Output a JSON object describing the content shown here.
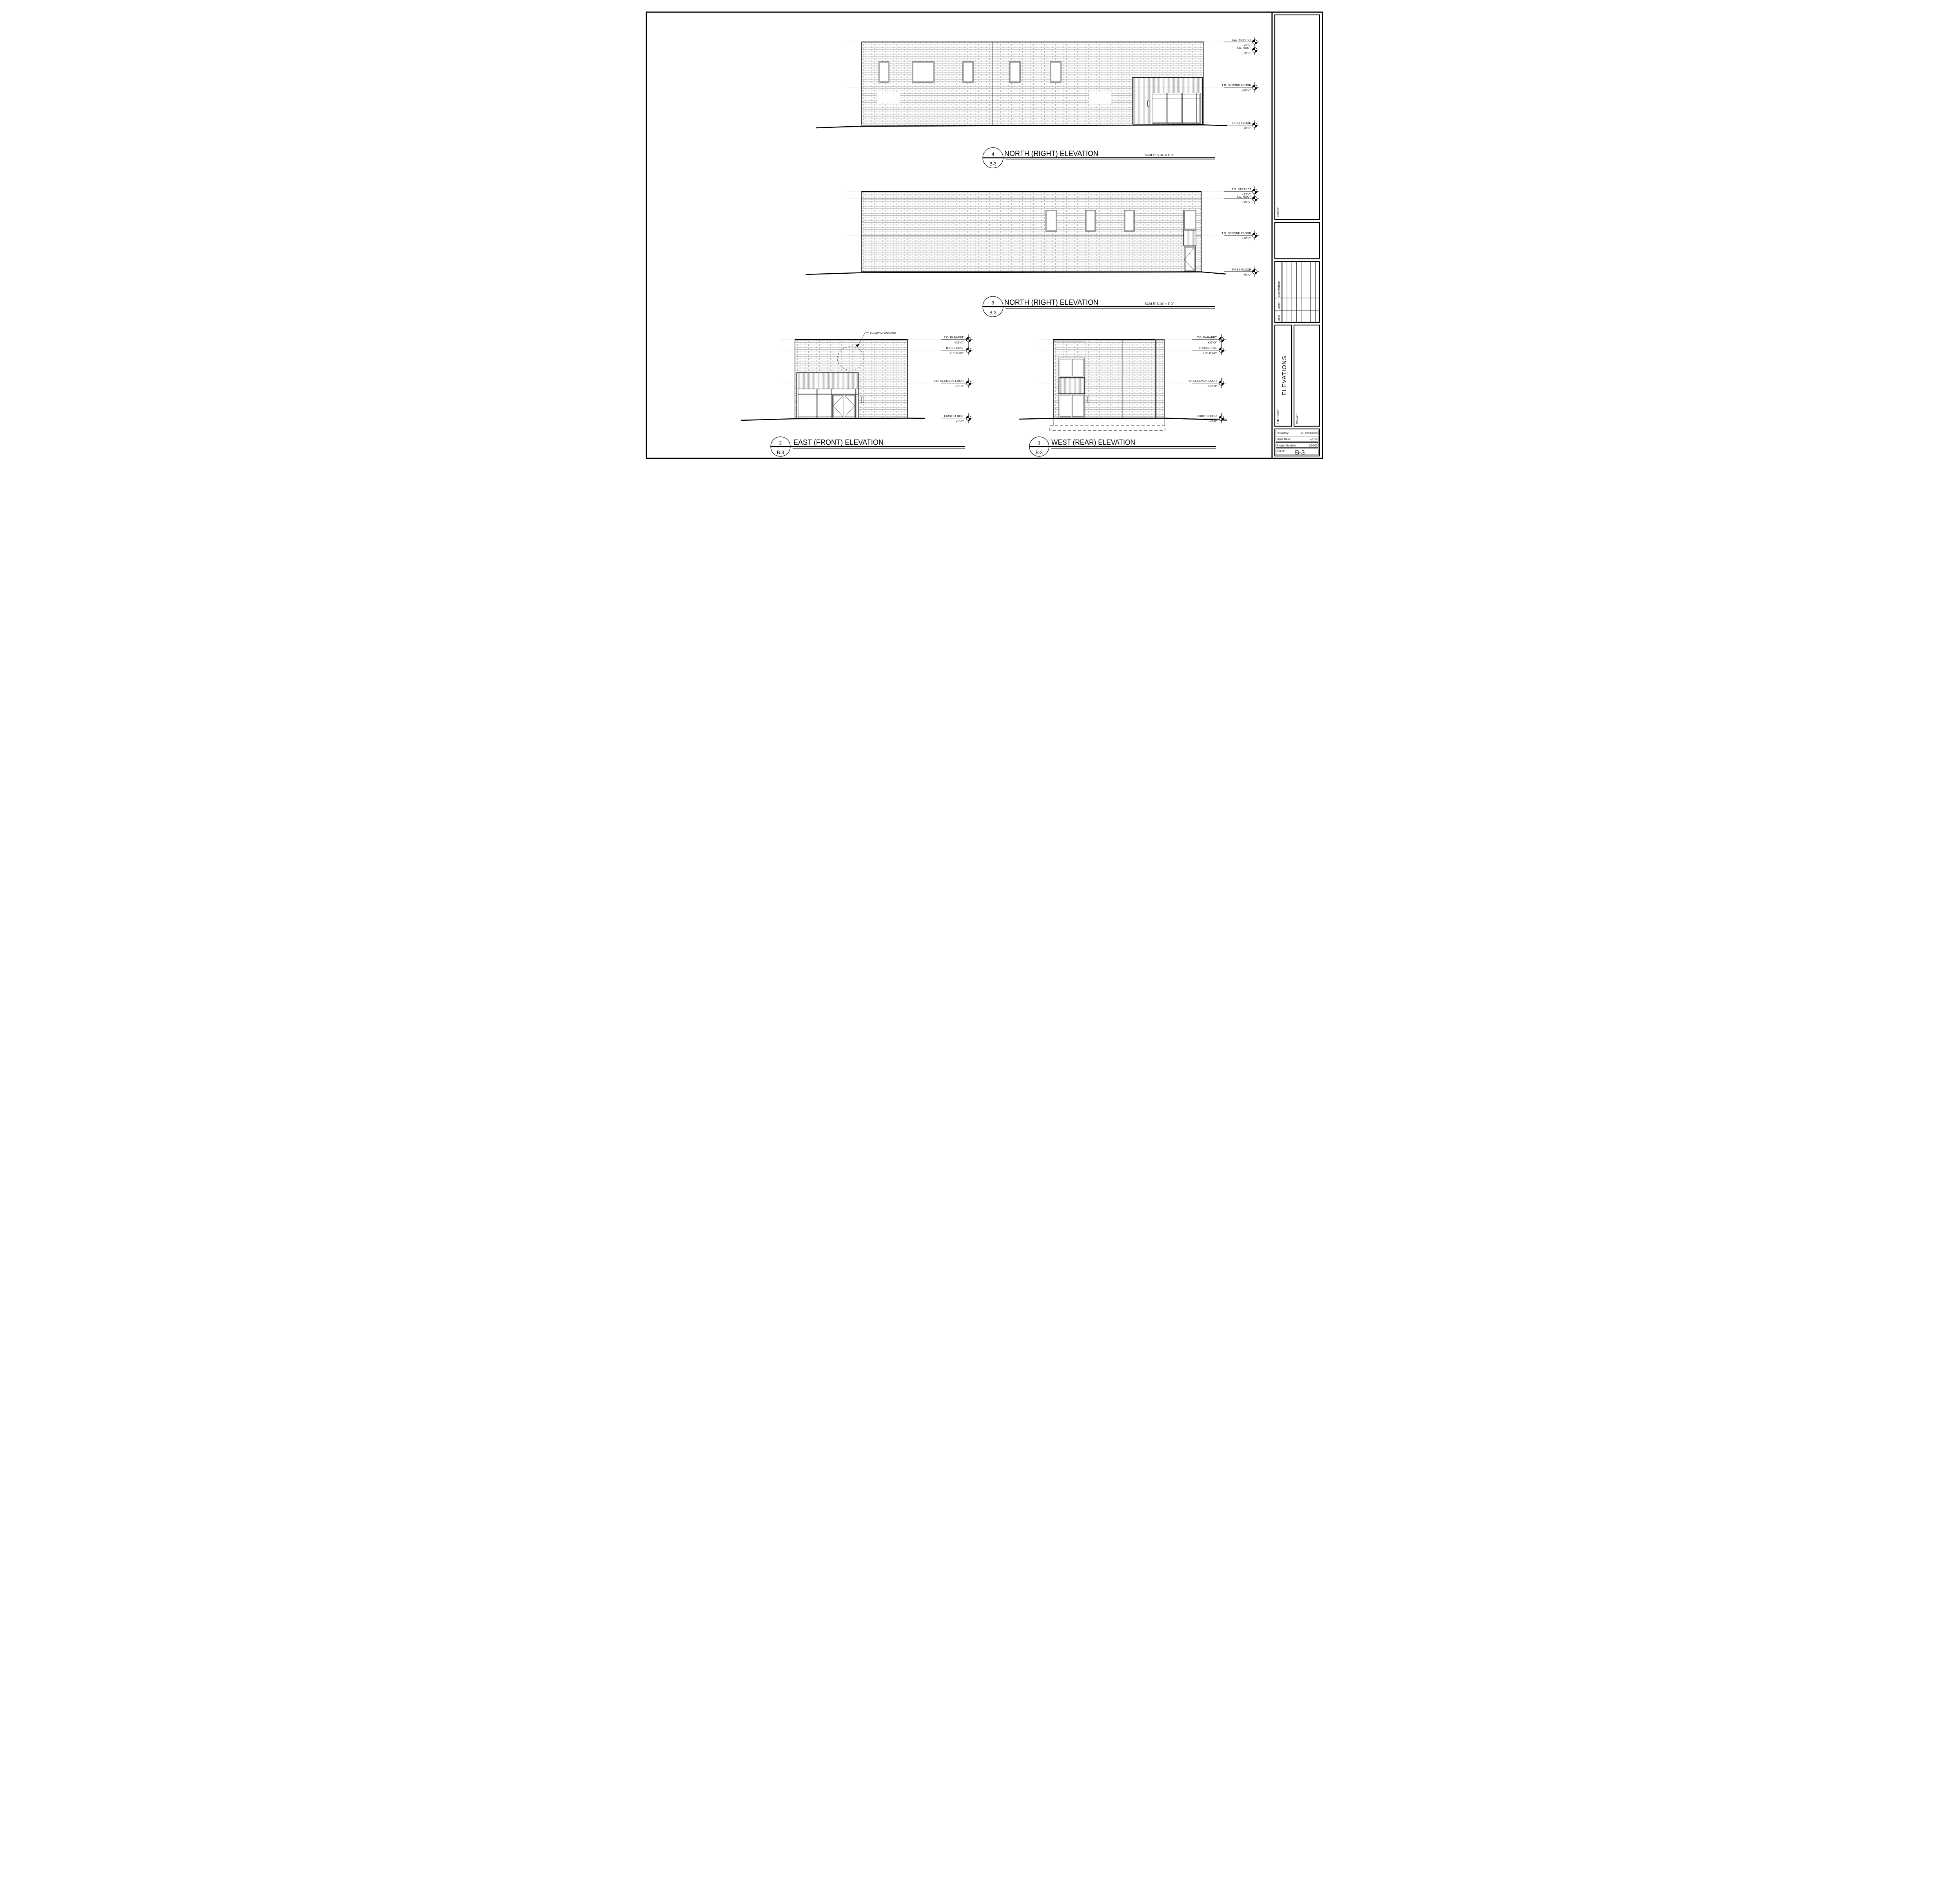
{
  "titleblock": {
    "owner_label": "Owner:",
    "rev_label": "Rev:",
    "date_label": "Date:",
    "description_label": "Description:",
    "title_sheet_label": "Title Sheet:",
    "title_sheet_value": "ELEVATIONS",
    "project_label": "Project:",
    "drawn_by_label": "Drawn by:",
    "drawn_by_value": "D. Templeton",
    "issue_date_label": "Issue Date:",
    "issue_date_value": "5-1-24",
    "project_number_label": "Project Number:",
    "project_number_value": "24-005",
    "sheet_label": "Sheet:",
    "sheet_value": "B-3"
  },
  "levels": {
    "parapet_label": "T.O. PARAPET",
    "parapet_value": "+22'-0\"",
    "roof_label": "T.O. ROOF",
    "roof_value": "+20'-0\"",
    "truss_label": "TRUSS BRG.",
    "truss_value": "+19'-0 1/2\"",
    "second_label": "T.O. SECOND FLOOR",
    "second_value": "+10'-0\"",
    "first_label": "FIRST FLOOR",
    "first_value": "+0'-0\""
  },
  "views": [
    {
      "number": "4",
      "sheet": "B-3",
      "title": "NORTH (RIGHT) ELEVATION",
      "scale": "SCALE: 3/16\" = 1'-0\""
    },
    {
      "number": "3",
      "sheet": "B-3",
      "title": "NORTH (RIGHT) ELEVATION",
      "scale": "SCALE: 3/16\" = 1'-0\""
    },
    {
      "number": "2",
      "sheet": "B-3",
      "title": "EAST (FRONT) ELEVATION",
      "scale": ""
    },
    {
      "number": "1",
      "sheet": "B-3",
      "title": "WEST (REAR) ELEVATION",
      "scale": ""
    }
  ],
  "annotations": {
    "building_signage": "BUILDING SIGNAGE"
  }
}
